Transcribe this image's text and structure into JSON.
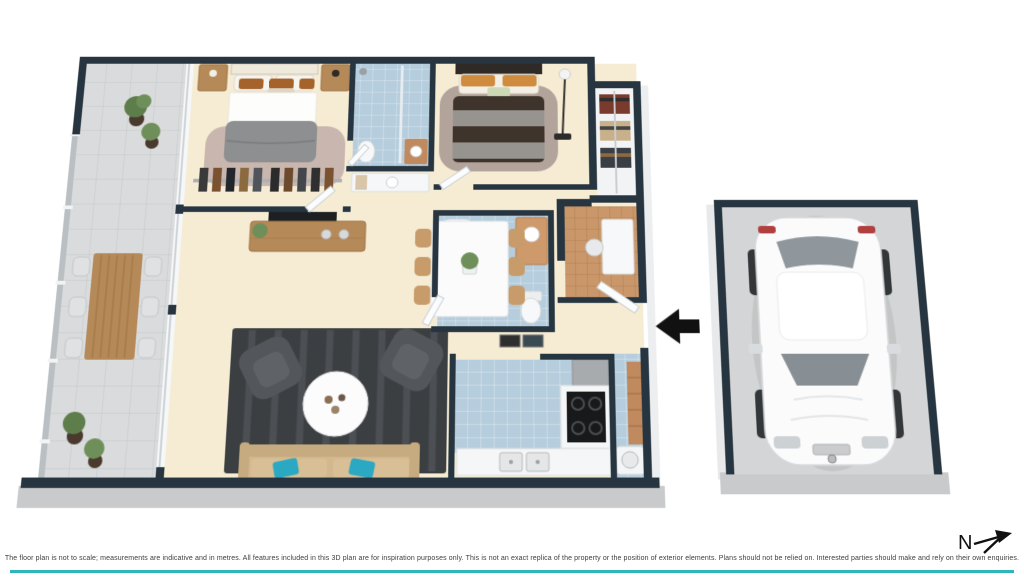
{
  "page": {
    "background": "#ffffff",
    "type": "3d-floor-plan-render"
  },
  "plan": {
    "rooms": [
      "balcony",
      "master-bedroom",
      "walk-in-robe",
      "ensuite",
      "bedroom-2",
      "wardrobe",
      "study-nook",
      "bathroom",
      "kitchen",
      "laundry",
      "living-room",
      "dining-area",
      "entry",
      "garage"
    ],
    "furniture": [
      "double-bed",
      "nightstands",
      "outdoor-dining-table",
      "outdoor-chairs",
      "potted-plants",
      "tv-unit",
      "tv",
      "dining-table",
      "dining-chairs",
      "armchairs",
      "coffee-table",
      "sofa",
      "bathtub",
      "vanity",
      "toilet",
      "shower",
      "cooktop",
      "fridge",
      "double-sink",
      "washing-machine",
      "floor-lamp",
      "white-car"
    ],
    "entry_arrow_direction": "left"
  },
  "north_indicator": {
    "label": "N"
  },
  "disclaimer": {
    "text": "The floor plan is not to scale; measurements are indicative and in metres. All features included in this 3D plan are for inspiration purposes only. This is not an exact replica of the property or the position of exterior elements. Plans should not be relied on. Interested parties should make and rely on their own enquiries."
  },
  "colors": {
    "wall": "#263540",
    "floor_interior": "#f6ecd4",
    "floor_balcony": "#d9dbdc",
    "tile_blue": "#b5cddd",
    "timber": "#b68a58",
    "timber_light": "#c89c6a",
    "rug_master": "#c9b6ae",
    "rug_bedroom2": "#b3a49b",
    "rug_living": "#3c3f42",
    "sofa_beige": "#d3b88e",
    "cushion_teal": "#2ba8c2",
    "armchair_gray": "#53565a",
    "duvet_gray": "#8d8f91",
    "duvet_brown": "#3e342c",
    "pillow_brown": "#a5622a",
    "pillow_orange": "#cf8b3e",
    "laundry_bench": "#c08a5e",
    "garage_floor": "#d3d5d6",
    "car_white": "#fbfbfc",
    "skirt_gray": "#c8cacc",
    "accent_teal": "#2eb6bc",
    "arrow_black": "#111111"
  }
}
